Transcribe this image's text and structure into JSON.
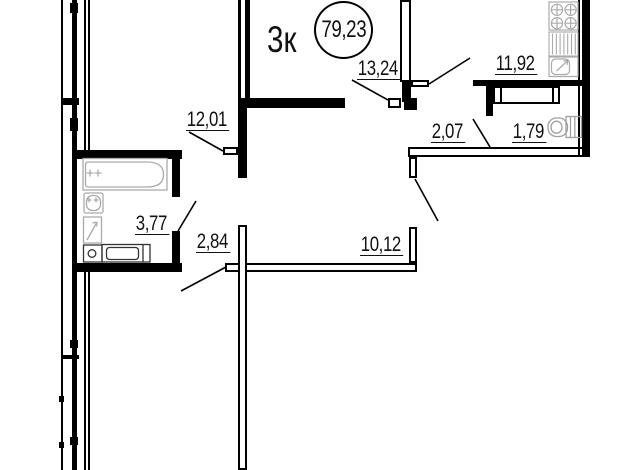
{
  "plan": {
    "header": {
      "apartment_type": "3к",
      "total_area": "79,23"
    },
    "rooms": [
      {
        "name": "bedroom-top-left",
        "area": "12,01"
      },
      {
        "name": "living-room-top",
        "area": "13,24"
      },
      {
        "name": "kitchen",
        "area": "11,92"
      },
      {
        "name": "hallway",
        "area": "2,07"
      },
      {
        "name": "wc",
        "area": "1,79"
      },
      {
        "name": "bathroom",
        "area": "3,77"
      },
      {
        "name": "corridor",
        "area": "2,84"
      },
      {
        "name": "room-bottom",
        "area": "10,12"
      }
    ],
    "fixtures": [
      "bathtub",
      "wash-basin",
      "water-heater",
      "floor-drain",
      "washing-machine",
      "stove",
      "dish-rack",
      "kitchen-sink",
      "dining-table",
      "toilet"
    ],
    "colors": {
      "wall": "#000000",
      "fixture": "#aaaaaa",
      "appliance": "#333333"
    }
  }
}
